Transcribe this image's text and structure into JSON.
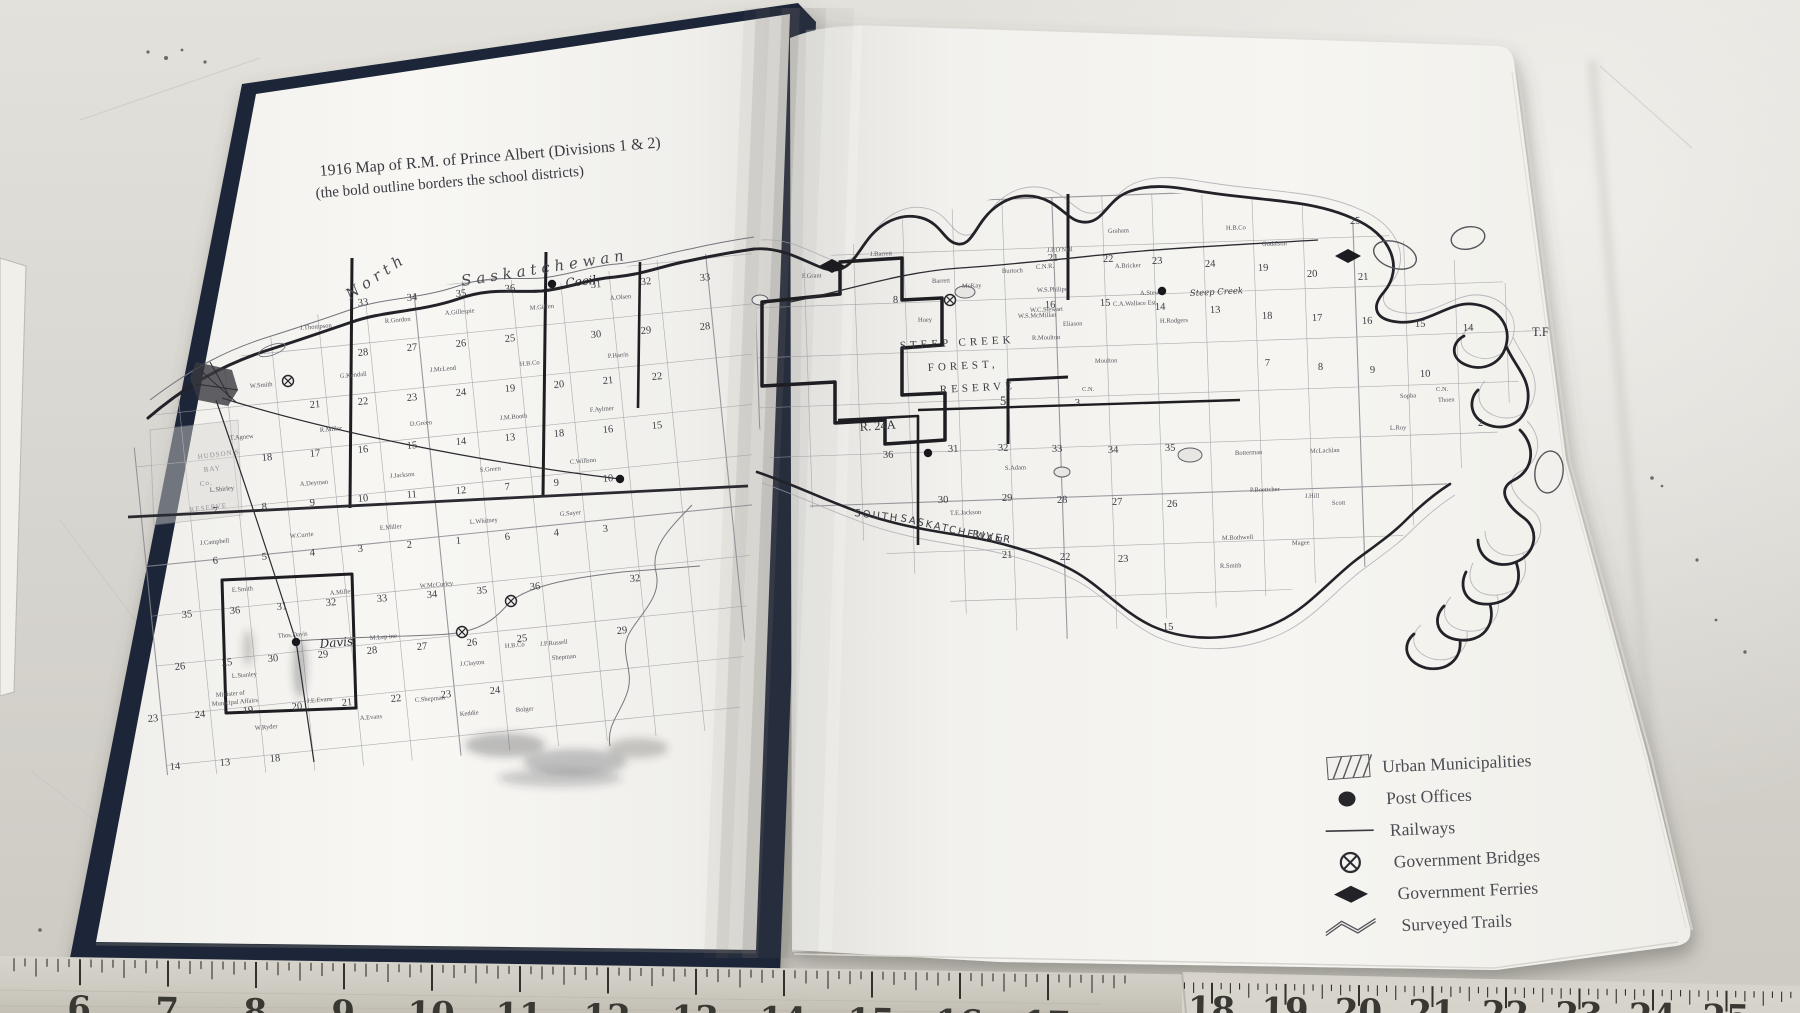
{
  "title": {
    "line1": "1916 Map of R.M. of Prince Albert (Divisions 1 & 2)",
    "line2": "(the bold outline borders the school districts)"
  },
  "legend": {
    "items": [
      {
        "type": "urban",
        "label": "Urban Municipalities"
      },
      {
        "type": "post",
        "label": "Post Offices"
      },
      {
        "type": "rail",
        "label": "Railways"
      },
      {
        "type": "bridge",
        "label": "Government Bridges"
      },
      {
        "type": "ferry",
        "label": "Government Ferries"
      },
      {
        "type": "trail",
        "label": "Surveyed Trails"
      }
    ]
  },
  "ruler": {
    "segments": [
      {
        "first": 6,
        "last": 17,
        "x0": 80,
        "step": 88,
        "dy": 0,
        "ny": 49,
        "clamp": [
          0,
          1182
        ]
      },
      {
        "first": 18,
        "last": 25,
        "x0": 1212,
        "step": 73.5,
        "dy": 6,
        "ny": 26,
        "clamp": [
          1182,
          1800
        ]
      }
    ]
  },
  "map": {
    "labels": [
      {
        "t": "North",
        "x": 350,
        "y": 300,
        "c": "river",
        "r": -34
      },
      {
        "t": "Saskatchewan",
        "x": 462,
        "y": 286,
        "c": "river",
        "r": -9
      },
      {
        "t": "SOUTH",
        "x": 854,
        "y": 516,
        "c": "riverhand",
        "r": 7
      },
      {
        "t": "SASKATCHEWAN",
        "x": 900,
        "y": 521,
        "c": "riverhand",
        "r": 13
      },
      {
        "t": "RIVER",
        "x": 972,
        "y": 537,
        "c": "riverhand",
        "r": 9
      },
      {
        "t": "Cecil",
        "x": 566,
        "y": 287,
        "c": "place",
        "r": -6
      },
      {
        "t": "Davis",
        "x": 320,
        "y": 648,
        "c": "place",
        "r": -5
      },
      {
        "t": "Steep Creek",
        "x": 1190,
        "y": 296,
        "c": "placesm",
        "r": -3
      },
      {
        "t": "STEEP CREEK",
        "x": 900,
        "y": 349,
        "c": "big",
        "r": -3
      },
      {
        "t": "FOREST,",
        "x": 928,
        "y": 371,
        "c": "big",
        "r": -3
      },
      {
        "t": "RESERVE",
        "x": 940,
        "y": 393,
        "c": "big",
        "r": -3
      },
      {
        "t": "5",
        "x": 1000,
        "y": 405,
        "c": "num2",
        "r": 0
      },
      {
        "t": "R. 24A",
        "x": 860,
        "y": 431,
        "c": "num2",
        "r": -4
      },
      {
        "t": "C.N.R.",
        "x": 1036,
        "y": 269,
        "c": "tiny",
        "r": -4
      },
      {
        "t": "C.N.",
        "x": 1082,
        "y": 391,
        "c": "tiny",
        "r": 0
      },
      {
        "t": "C.N.",
        "x": 1436,
        "y": 391,
        "c": "tiny",
        "r": 0
      },
      {
        "t": "T.F",
        "x": 1532,
        "y": 336,
        "c": "num2",
        "r": 0
      },
      {
        "t": "HUDSON'S",
        "x": 198,
        "y": 459,
        "c": "faint",
        "r": -7
      },
      {
        "t": "BAY",
        "x": 204,
        "y": 472,
        "c": "faint",
        "r": -7
      },
      {
        "t": "Co.",
        "x": 200,
        "y": 486,
        "c": "faint",
        "r": -7
      },
      {
        "t": "RESERVE",
        "x": 190,
        "y": 512,
        "c": "faint",
        "r": -7
      },
      {
        "t": "Minister of",
        "x": 216,
        "y": 697,
        "c": "tiny",
        "r": -5
      },
      {
        "t": "Municipal Affairs",
        "x": 212,
        "y": 706,
        "c": "tiny",
        "r": -5
      }
    ],
    "section_numbers": [
      [
        "33",
        358,
        306
      ],
      [
        "34",
        407,
        301
      ],
      [
        "35",
        456,
        297
      ],
      [
        "36",
        505,
        292
      ],
      [
        "31",
        591,
        288
      ],
      [
        "32",
        641,
        285
      ],
      [
        "33",
        700,
        281
      ],
      [
        "28",
        358,
        356
      ],
      [
        "27",
        407,
        351
      ],
      [
        "26",
        456,
        347
      ],
      [
        "25",
        505,
        342
      ],
      [
        "30",
        591,
        338
      ],
      [
        "29",
        641,
        334
      ],
      [
        "28",
        700,
        330
      ],
      [
        "21",
        310,
        408
      ],
      [
        "22",
        358,
        405
      ],
      [
        "23",
        407,
        401
      ],
      [
        "24",
        456,
        396
      ],
      [
        "19",
        505,
        392
      ],
      [
        "20",
        554,
        388
      ],
      [
        "21",
        603,
        384
      ],
      [
        "22",
        652,
        380
      ],
      [
        "18",
        262,
        461
      ],
      [
        "17",
        310,
        457
      ],
      [
        "16",
        358,
        453
      ],
      [
        "15",
        407,
        449
      ],
      [
        "14",
        456,
        445
      ],
      [
        "13",
        505,
        441
      ],
      [
        "18",
        554,
        437
      ],
      [
        "16",
        603,
        433
      ],
      [
        "15",
        652,
        429
      ],
      [
        "7",
        213,
        514
      ],
      [
        "8",
        262,
        510
      ],
      [
        "9",
        310,
        506
      ],
      [
        "10",
        358,
        502
      ],
      [
        "11",
        407,
        498
      ],
      [
        "12",
        456,
        494
      ],
      [
        "7",
        505,
        490
      ],
      [
        "9",
        554,
        486
      ],
      [
        "10",
        603,
        482
      ],
      [
        "6",
        213,
        564
      ],
      [
        "5",
        262,
        560
      ],
      [
        "4",
        310,
        556
      ],
      [
        "3",
        358,
        552
      ],
      [
        "2",
        407,
        548
      ],
      [
        "1",
        456,
        544
      ],
      [
        "6",
        505,
        540
      ],
      [
        "4",
        554,
        536
      ],
      [
        "3",
        603,
        532
      ],
      [
        "35",
        182,
        618
      ],
      [
        "36",
        230,
        614
      ],
      [
        "31",
        277,
        610
      ],
      [
        "32",
        326,
        606
      ],
      [
        "33",
        377,
        602
      ],
      [
        "34",
        427,
        598
      ],
      [
        "35",
        477,
        594
      ],
      [
        "36",
        530,
        590
      ],
      [
        "32",
        630,
        582
      ],
      [
        "26",
        175,
        670
      ],
      [
        "25",
        222,
        666
      ],
      [
        "30",
        268,
        662
      ],
      [
        "29",
        318,
        658
      ],
      [
        "28",
        367,
        654
      ],
      [
        "27",
        417,
        650
      ],
      [
        "26",
        467,
        646
      ],
      [
        "25",
        517,
        642
      ],
      [
        "29",
        617,
        634
      ],
      [
        "23",
        148,
        722
      ],
      [
        "24",
        195,
        718
      ],
      [
        "19",
        243,
        714
      ],
      [
        "20",
        292,
        710
      ],
      [
        "21",
        342,
        706
      ],
      [
        "22",
        391,
        702
      ],
      [
        "23",
        441,
        698
      ],
      [
        "24",
        490,
        694
      ],
      [
        "14",
        170,
        770
      ],
      [
        "13",
        220,
        766
      ],
      [
        "18",
        270,
        762
      ],
      [
        "21",
        1048,
        261
      ],
      [
        "22",
        1103,
        262
      ],
      [
        "23",
        1152,
        264
      ],
      [
        "24",
        1205,
        267
      ],
      [
        "25",
        1350,
        224
      ],
      [
        "19",
        1258,
        271
      ],
      [
        "20",
        1307,
        277
      ],
      [
        "21",
        1358,
        280
      ],
      [
        "18",
        1262,
        319
      ],
      [
        "17",
        1312,
        321
      ],
      [
        "16",
        1362,
        324
      ],
      [
        "15",
        1415,
        327
      ],
      [
        "14",
        1463,
        331
      ],
      [
        "16",
        1045,
        308
      ],
      [
        "15",
        1100,
        306
      ],
      [
        "14",
        1155,
        310
      ],
      [
        "13",
        1210,
        313
      ],
      [
        "7",
        1265,
        366
      ],
      [
        "8",
        1318,
        370
      ],
      [
        "9",
        1370,
        373
      ],
      [
        "10",
        1420,
        377
      ],
      [
        "2",
        1478,
        426
      ],
      [
        "3",
        1075,
        406
      ],
      [
        "8",
        893,
        303
      ],
      [
        "36",
        883,
        458
      ],
      [
        "31",
        948,
        452
      ],
      [
        "32",
        998,
        451
      ],
      [
        "33",
        1052,
        452
      ],
      [
        "34",
        1108,
        453
      ],
      [
        "35",
        1165,
        451
      ],
      [
        "30",
        938,
        503
      ],
      [
        "29",
        1002,
        501
      ],
      [
        "28",
        1057,
        503
      ],
      [
        "27",
        1112,
        505
      ],
      [
        "26",
        1167,
        507
      ],
      [
        "21",
        1002,
        558
      ],
      [
        "22",
        1060,
        560
      ],
      [
        "23",
        1118,
        562
      ],
      [
        "15",
        1163,
        630
      ]
    ],
    "names": [
      [
        "J.Thompson",
        300,
        330
      ],
      [
        "R.Gordon",
        385,
        323
      ],
      [
        "A.Gillespie",
        445,
        315
      ],
      [
        "M.Giffen",
        530,
        310
      ],
      [
        "A.Olsen",
        610,
        300
      ],
      [
        "W.Smith",
        250,
        388
      ],
      [
        "G.Kendall",
        340,
        378
      ],
      [
        "J.McLeod",
        430,
        372
      ],
      [
        "H.B.Co",
        520,
        366
      ],
      [
        "P.Harris",
        608,
        358
      ],
      [
        "T.Agnew",
        230,
        440
      ],
      [
        "R.Miller",
        320,
        432
      ],
      [
        "D.Green",
        410,
        426
      ],
      [
        "J.M.Booth",
        500,
        420
      ],
      [
        "F.Aylmer",
        590,
        412
      ],
      [
        "L.Shirley",
        210,
        492
      ],
      [
        "A.Deyman",
        300,
        486
      ],
      [
        "J.Jackson",
        390,
        478
      ],
      [
        "S.Green",
        480,
        472
      ],
      [
        "C.Willson",
        570,
        464
      ],
      [
        "J.Campbell",
        200,
        545
      ],
      [
        "W.Currie",
        290,
        538
      ],
      [
        "E.Miller",
        380,
        530
      ],
      [
        "L.Whitney",
        470,
        524
      ],
      [
        "G.Sayer",
        560,
        516
      ],
      [
        "E.Smith",
        232,
        592
      ],
      [
        "A.Miller",
        330,
        595
      ],
      [
        "W.McCurley",
        420,
        588
      ],
      [
        "J.P.Russell",
        540,
        646
      ],
      [
        "H.B.Co",
        505,
        648
      ],
      [
        "L.Stanley",
        232,
        678
      ],
      [
        "Thos.Davis",
        278,
        638
      ],
      [
        "M.Lep ine",
        370,
        640
      ],
      [
        "J.Clayton",
        460,
        666
      ],
      [
        "Shepman",
        552,
        660
      ],
      [
        "J.E.Evans",
        307,
        703
      ],
      [
        "C.Shepman",
        415,
        702
      ],
      [
        "A.Evans",
        360,
        720
      ],
      [
        "W.Ryder",
        255,
        730
      ],
      [
        "Keddie",
        460,
        716
      ],
      [
        "Bolger",
        516,
        712
      ],
      [
        "Barrett",
        932,
        283
      ],
      [
        "McKay",
        962,
        288
      ],
      [
        "Burtoch",
        1002,
        273
      ],
      [
        "J.P.O'Neil",
        1047,
        252
      ],
      [
        "A.Bricker",
        1115,
        268
      ],
      [
        "Graham",
        1108,
        233
      ],
      [
        "A.Stewart",
        1140,
        295
      ],
      [
        "H.B.Co",
        1226,
        230
      ],
      [
        "Gudalson",
        1262,
        246
      ],
      [
        "Hoey",
        918,
        322
      ],
      [
        "W.S.Philips",
        1037,
        292
      ],
      [
        "W.C.Stewart",
        1030,
        312
      ],
      [
        "W.S.McMillan",
        1018,
        318
      ],
      [
        "Eliason",
        1063,
        326
      ],
      [
        "C.A.Wallace Est",
        1113,
        306
      ],
      [
        "H.Rodgers",
        1160,
        323
      ],
      [
        "R.Moulton",
        1032,
        340
      ],
      [
        "Moulton",
        1095,
        363
      ],
      [
        "S.Adam",
        1005,
        470
      ],
      [
        "T.E.Jackson",
        950,
        515
      ],
      [
        "Botterman",
        1235,
        455
      ],
      [
        "McLachlan",
        1310,
        453
      ],
      [
        "P.Boettcher",
        1250,
        492
      ],
      [
        "J.Hill",
        1305,
        498
      ],
      [
        "Scott",
        1332,
        505
      ],
      [
        "M.Bothwell",
        1222,
        540
      ],
      [
        "Magee",
        1292,
        545
      ],
      [
        "R.Smith",
        1220,
        568
      ],
      [
        "F.Grant",
        802,
        278
      ],
      [
        "J.Barrett",
        870,
        256
      ],
      [
        "Sopha",
        1400,
        398
      ],
      [
        "Thoen",
        1438,
        402
      ],
      [
        "L.Roy",
        1390,
        430
      ]
    ],
    "symbols": {
      "post_offices": [
        [
          552,
          284
        ],
        [
          620,
          479
        ],
        [
          296,
          642
        ],
        [
          928,
          453
        ],
        [
          1162,
          291
        ]
      ],
      "bridges": [
        [
          288,
          381
        ],
        [
          462,
          632
        ],
        [
          511,
          601
        ],
        [
          950,
          300
        ]
      ],
      "ferries": [
        [
          832,
          266
        ],
        [
          1348,
          256
        ]
      ]
    }
  },
  "colors": {
    "book_cover": "#1c2537",
    "page_white": "#f6f5f1",
    "map_ink": "#26262b",
    "grid_line": "#9e9ca2",
    "legend_text": "#4b4b52",
    "table_surface": "#d8d6d0",
    "ruler_base": "#cfccc3",
    "ruler_marks": "#33312c"
  }
}
